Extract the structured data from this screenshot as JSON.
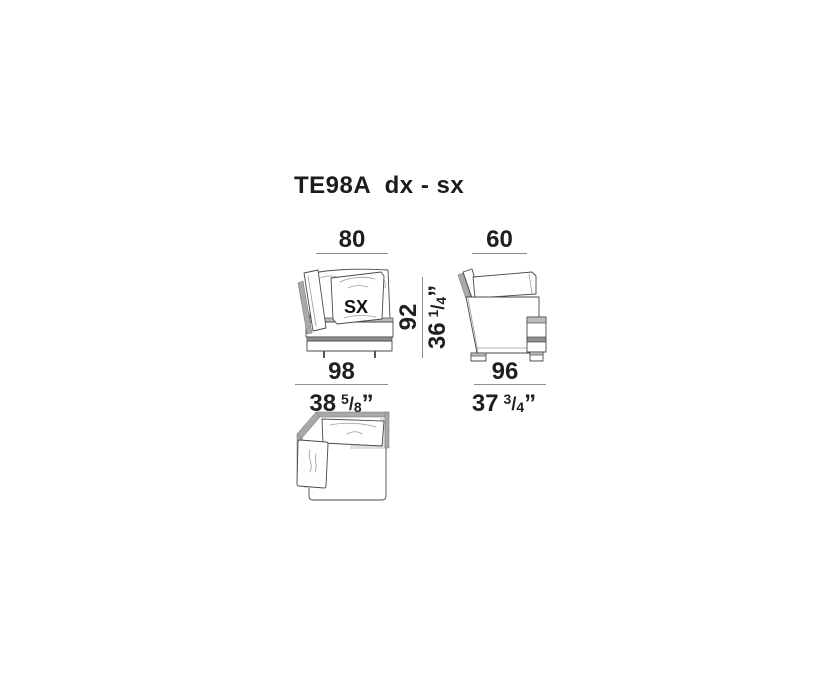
{
  "title": "TE98A  dx - sx",
  "drawing": {
    "pillow_label": "SX"
  },
  "dimensions": {
    "slash": "/",
    "inch_mark": "”",
    "front": {
      "top_width_cm": "80",
      "overall_width_cm": "98",
      "overall_width_in": {
        "whole": "38",
        "num": "5",
        "den": "8"
      },
      "height_cm": "92",
      "height_in": {
        "whole": "36",
        "num": "1",
        "den": "4"
      }
    },
    "side": {
      "top_width_cm": "60",
      "overall_depth_cm": "96",
      "overall_depth_in": {
        "whole": "37",
        "num": "3",
        "den": "4"
      }
    }
  },
  "colors": {
    "text": "#1f1f1f",
    "dim_line": "#8c8c8c",
    "outline": "#4a4a4a",
    "frame_gray": "#a9a9a9",
    "band_light": "#bcbcbc",
    "band_dark": "#8f8f8f",
    "shadow": "#dedede"
  }
}
